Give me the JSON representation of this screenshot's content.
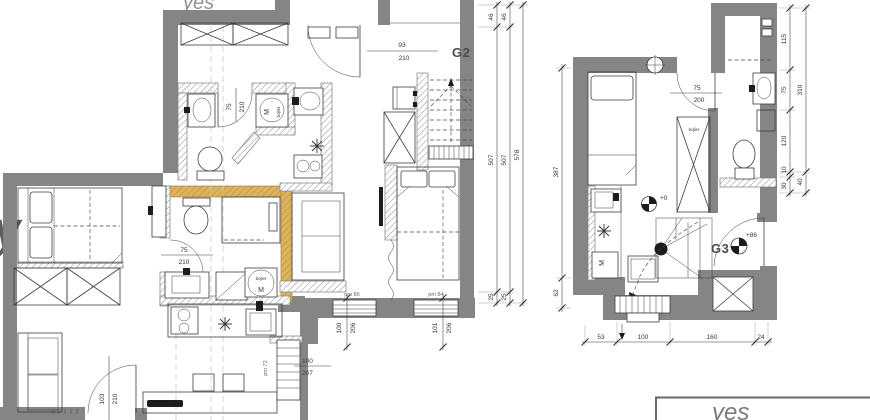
{
  "g2": {
    "label": "G2",
    "doors": {
      "entry_w": "93",
      "entry_h": "210",
      "bath1_w": "75",
      "bath1_h": "210",
      "bath2_w": "75",
      "bath2_h": "210",
      "room_w": "103",
      "room_h": "210"
    },
    "openings": {
      "stair_code": "pm 72",
      "stair_w": "100",
      "stair_h": "207",
      "win1_code": "pm 86",
      "win1_w": "100",
      "win1_h": "206",
      "win2_code": "pm 84",
      "win2_w": "101",
      "win2_h": "206"
    },
    "washer1_label": "M",
    "washer1_note": "bojler",
    "washer2_label": "M",
    "washer2_note": "bojler",
    "dims_right": {
      "a1": "46",
      "a2": "507",
      "a3": "25",
      "b1": "46",
      "b2": "507",
      "b3": "25",
      "total": "578"
    }
  },
  "g3": {
    "label": "G3",
    "door_w": "75",
    "door_h": "200",
    "closet_note": "bojler",
    "washer_label": "M",
    "level_zero": "+0",
    "level_upper": "+86",
    "dims_left": {
      "a": "387",
      "b": "62"
    },
    "dims_right": {
      "s1": "115",
      "s2": "75",
      "s3": "120",
      "s4": "10",
      "s5": "30",
      "t1": "310",
      "t2": "40"
    },
    "dims_bottom": {
      "s1": "53",
      "s2": "100",
      "s3": "160",
      "s4": "24"
    }
  },
  "watermarks": {
    "left": "y",
    "top": "yes",
    "corner": "yes"
  }
}
